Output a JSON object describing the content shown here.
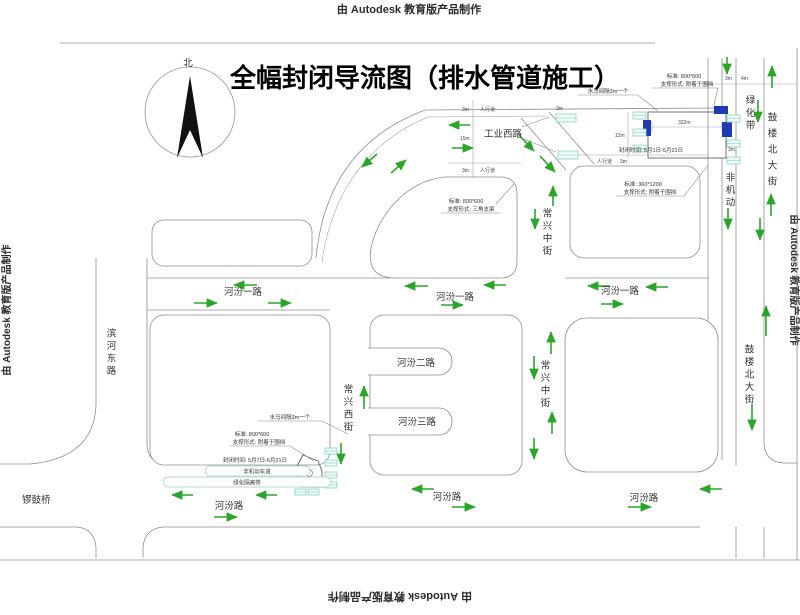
{
  "watermark": "由 Autodesk 教育版产品制作",
  "title": "全幅封闭导流图（排水管道施工）",
  "north": "北",
  "labels": {
    "gongye_xilu": "工业西路",
    "changxing_zhongjie": "常兴中街",
    "changxing_xijie": "常兴西街",
    "binhe_donglu": "滨河东路",
    "gulou_beidajie": "鼓楼北大街",
    "lvhuadai": "绿化带",
    "feijidong": "非机动",
    "hefen_yilu": "河汾一路",
    "hefen_erlu": "河汾二路",
    "hefen_sanlu": "河汾三路",
    "hefen_lu": "河汾路",
    "luogu_qiao": "锣鼓桥"
  },
  "annotations": {
    "shuima": "水马间隔3m一个",
    "std_800600": "标准: 800*600",
    "support_weidang": "支撑形式: 附着于围挡",
    "std_3601200": "标准: 360*1200",
    "support_sanjiao": "支撑形式: 三角支架",
    "closure_top": "封闭时间: 5月1日-5月21日",
    "closure_bottom": "封闭时间: 5月7日-6月21日",
    "lane_nonmotor": "非机动车道",
    "lane_green_belt": "绿化隔离带"
  },
  "dims": {
    "m3": "3m",
    "m4": "4m",
    "m12": "12m",
    "m15": "15m",
    "m322": "322m",
    "sidewalk": "人行道"
  },
  "colors": {
    "arrow_green": "#2aa52a",
    "barrier_teal": "#86d2c6",
    "sign_blue": "#1f3bb3",
    "line_gray": "#8f8f8f",
    "text_dark": "#333333"
  }
}
